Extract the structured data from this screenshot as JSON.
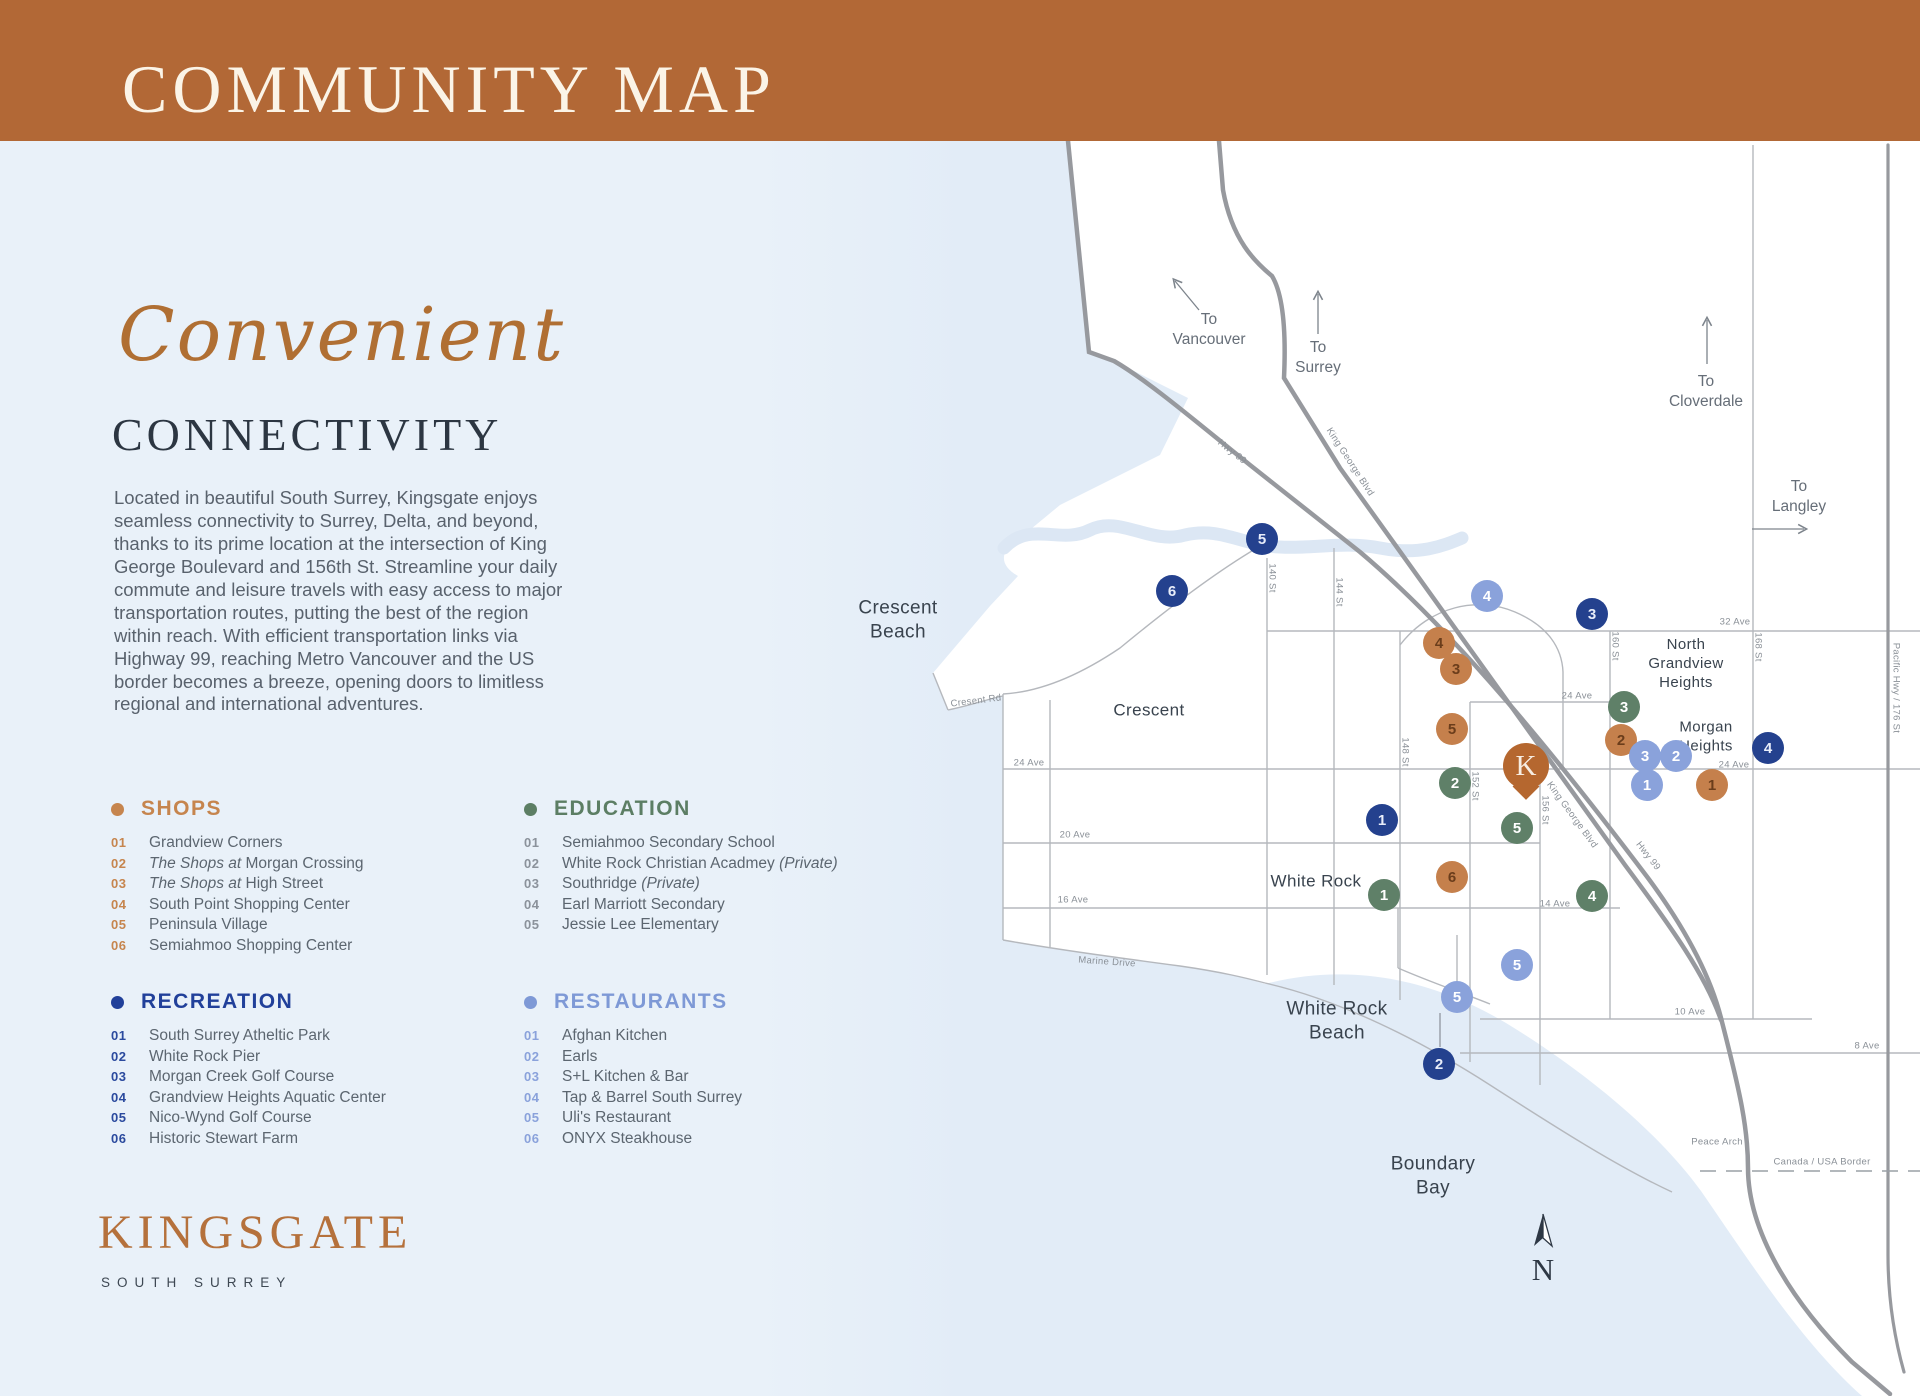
{
  "header": {
    "title": "COMMUNITY MAP"
  },
  "intro": {
    "script_word": "Convenient",
    "heading": "CONNECTIVITY",
    "paragraph": "Located in beautiful South Surrey, Kingsgate enjoys seamless connectivity to Surrey, Delta, and beyond, thanks to its prime location at the intersection of King George Boulevard and 156th St. Streamline your daily commute and leisure travels with easy access to major transportation routes, putting the best of the region within reach. With efficient transportation links via Highway 99, reaching Metro Vancouver and the US border becomes a breeze, opening doors to limitless regional and international adventures."
  },
  "legend": {
    "sections": [
      {
        "id": "shops",
        "label": "SHOPS",
        "color": "#C6854E",
        "number_color": "#C6854E",
        "items": [
          {
            "num": "01",
            "name": "Grandview Corners"
          },
          {
            "num": "02",
            "italic_prefix": "The Shops at",
            "name": " Morgan Crossing"
          },
          {
            "num": "03",
            "italic_prefix": "The Shops at",
            "name": " High Street"
          },
          {
            "num": "04",
            "name": "South Point Shopping Center"
          },
          {
            "num": "05",
            "name": "Peninsula Village"
          },
          {
            "num": "06",
            "name": "Semiahmoo Shopping Center"
          }
        ]
      },
      {
        "id": "education",
        "label": "EDUCATION",
        "color": "#5C7E64",
        "number_color": "#8B929B",
        "items": [
          {
            "num": "01",
            "name": "Semiahmoo Secondary School"
          },
          {
            "num": "02",
            "name": "White Rock Christian Acadmey ",
            "italic_suffix": "(Private)"
          },
          {
            "num": "03",
            "name": "Southridge ",
            "italic_suffix": "(Private)"
          },
          {
            "num": "04",
            "name": "Earl Marriott Secondary"
          },
          {
            "num": "05",
            "name": "Jessie Lee Elementary"
          }
        ]
      },
      {
        "id": "recreation",
        "label": "RECREATION",
        "color": "#21409A",
        "number_color": "#2B4A9E",
        "items": [
          {
            "num": "01",
            "name": "South Surrey Atheltic Park"
          },
          {
            "num": "02",
            "name": "White Rock Pier"
          },
          {
            "num": "03",
            "name": "Morgan Creek Golf Course"
          },
          {
            "num": "04",
            "name": "Grandview Heights Aquatic Center"
          },
          {
            "num": "05",
            "name": "Nico-Wynd Golf Course"
          },
          {
            "num": "06",
            "name": "Historic Stewart Farm"
          }
        ]
      },
      {
        "id": "restaurants",
        "label": "RESTAURANTS",
        "color": "#7E99D6",
        "number_color": "#8AA2DB",
        "items": [
          {
            "num": "01",
            "name": "Afghan Kitchen"
          },
          {
            "num": "02",
            "name": "Earls"
          },
          {
            "num": "03",
            "name": "S+L Kitchen & Bar"
          },
          {
            "num": "04",
            "name": "Tap & Barrel South Surrey"
          },
          {
            "num": "05",
            "name": "Uli's Restaurant"
          },
          {
            "num": "06",
            "name": "ONYX Steakhouse"
          }
        ]
      }
    ]
  },
  "logo": {
    "name": "KINGSGATE",
    "subtitle": "SOUTH SURREY"
  },
  "map": {
    "pin": {
      "letter": "K",
      "color": "#B5672F",
      "x": 1526,
      "y": 766
    },
    "compass": {
      "letter": "N"
    },
    "categories": {
      "shops": {
        "bg": "#C5804C",
        "fg": "#6B3D1B"
      },
      "education": {
        "bg": "#5F8068",
        "fg": "#FFFFFF"
      },
      "recreation": {
        "bg": "#24418E",
        "fg": "#E8EDFA"
      },
      "restaurants": {
        "bg": "#8AA2DB",
        "fg": "#FFFFFF"
      }
    },
    "markers": [
      {
        "cat": "recreation",
        "num": "5",
        "x": 1262,
        "y": 539
      },
      {
        "cat": "recreation",
        "num": "6",
        "x": 1172,
        "y": 591
      },
      {
        "cat": "recreation",
        "num": "3",
        "x": 1592,
        "y": 614
      },
      {
        "cat": "recreation",
        "num": "4",
        "x": 1768,
        "y": 748
      },
      {
        "cat": "recreation",
        "num": "1",
        "x": 1382,
        "y": 820
      },
      {
        "cat": "recreation",
        "num": "2",
        "x": 1439,
        "y": 1064
      },
      {
        "cat": "shops",
        "num": "4",
        "x": 1439,
        "y": 643
      },
      {
        "cat": "shops",
        "num": "3",
        "x": 1456,
        "y": 669
      },
      {
        "cat": "shops",
        "num": "5",
        "x": 1452,
        "y": 729
      },
      {
        "cat": "shops",
        "num": "2",
        "x": 1621,
        "y": 740
      },
      {
        "cat": "shops",
        "num": "1",
        "x": 1712,
        "y": 785
      },
      {
        "cat": "shops",
        "num": "6",
        "x": 1452,
        "y": 877
      },
      {
        "cat": "education",
        "num": "3",
        "x": 1624,
        "y": 707
      },
      {
        "cat": "education",
        "num": "2",
        "x": 1455,
        "y": 783
      },
      {
        "cat": "education",
        "num": "5",
        "x": 1517,
        "y": 828
      },
      {
        "cat": "education",
        "num": "1",
        "x": 1384,
        "y": 895
      },
      {
        "cat": "education",
        "num": "4",
        "x": 1592,
        "y": 896
      },
      {
        "cat": "restaurants",
        "num": "4",
        "x": 1487,
        "y": 596
      },
      {
        "cat": "restaurants",
        "num": "3",
        "x": 1645,
        "y": 756
      },
      {
        "cat": "restaurants",
        "num": "2",
        "x": 1676,
        "y": 756
      },
      {
        "cat": "restaurants",
        "num": "1",
        "x": 1647,
        "y": 785
      },
      {
        "cat": "restaurants",
        "num": "5",
        "x": 1517,
        "y": 965
      },
      {
        "cat": "restaurants",
        "num": "5",
        "x": 1457,
        "y": 997
      }
    ],
    "region_labels": [
      {
        "id": "crescent-beach",
        "lines": [
          "Crescent",
          "Beach"
        ],
        "x": 898,
        "y": 620,
        "size": 19
      },
      {
        "id": "crescent",
        "lines": [
          "Crescent"
        ],
        "x": 1149,
        "y": 710,
        "size": 17
      },
      {
        "id": "white-rock",
        "lines": [
          "White Rock"
        ],
        "x": 1316,
        "y": 881,
        "size": 17
      },
      {
        "id": "white-rock-beach",
        "lines": [
          "White Rock",
          "Beach"
        ],
        "x": 1337,
        "y": 1021,
        "size": 19
      },
      {
        "id": "boundary-bay",
        "lines": [
          "Boundary",
          "Bay"
        ],
        "x": 1433,
        "y": 1176,
        "size": 19
      },
      {
        "id": "north-grandview-heights",
        "lines": [
          "North",
          "Grandview",
          "Heights"
        ],
        "x": 1686,
        "y": 664,
        "size": 15
      },
      {
        "id": "morgan-heights",
        "lines": [
          "Morgan",
          "Heights"
        ],
        "x": 1706,
        "y": 737,
        "size": 15
      }
    ],
    "direction_labels": [
      {
        "id": "to-vancouver",
        "lines": [
          "To",
          "Vancouver"
        ],
        "x": 1209,
        "y": 330
      },
      {
        "id": "to-surrey",
        "lines": [
          "To",
          "Surrey"
        ],
        "x": 1318,
        "y": 358
      },
      {
        "id": "to-cloverdale",
        "lines": [
          "To",
          "Cloverdale"
        ],
        "x": 1706,
        "y": 392
      },
      {
        "id": "to-langley",
        "lines": [
          "To",
          "Langley"
        ],
        "x": 1799,
        "y": 497
      }
    ],
    "road_labels": [
      {
        "text": "Hwy 99",
        "x": 1232,
        "y": 452,
        "rot": 38
      },
      {
        "text": "King George Blvd",
        "x": 1350,
        "y": 462,
        "rot": 57
      },
      {
        "text": "King George Blvd",
        "x": 1572,
        "y": 815,
        "rot": 54
      },
      {
        "text": "Hwy 99",
        "x": 1648,
        "y": 856,
        "rot": 52
      },
      {
        "text": "Cresent Rd",
        "x": 976,
        "y": 701,
        "rot": -7
      },
      {
        "text": "Marine Drive",
        "x": 1107,
        "y": 962,
        "rot": 4
      },
      {
        "text": "Peace Arch",
        "x": 1717,
        "y": 1142,
        "rot": 0
      },
      {
        "text": "Canada / USA Border",
        "x": 1822,
        "y": 1162,
        "rot": 0
      },
      {
        "text": "32 Ave",
        "x": 1735,
        "y": 622,
        "rot": 0
      },
      {
        "text": "24 Ave",
        "x": 1577,
        "y": 696,
        "rot": 0
      },
      {
        "text": "24 Ave",
        "x": 1029,
        "y": 763,
        "rot": 0
      },
      {
        "text": "24 Ave",
        "x": 1734,
        "y": 765,
        "rot": 0
      },
      {
        "text": "20 Ave",
        "x": 1075,
        "y": 835,
        "rot": 0
      },
      {
        "text": "16 Ave",
        "x": 1073,
        "y": 900,
        "rot": 0
      },
      {
        "text": "14 Ave",
        "x": 1555,
        "y": 904,
        "rot": 0
      },
      {
        "text": "10 Ave",
        "x": 1690,
        "y": 1012,
        "rot": 0
      },
      {
        "text": "8 Ave",
        "x": 1867,
        "y": 1046,
        "rot": 0
      },
      {
        "text": "140 St",
        "x": 1272,
        "y": 578,
        "rot": 90
      },
      {
        "text": "144 St",
        "x": 1339,
        "y": 592,
        "rot": 90
      },
      {
        "text": "148 St",
        "x": 1405,
        "y": 752,
        "rot": 90
      },
      {
        "text": "152 St",
        "x": 1475,
        "y": 786,
        "rot": 90
      },
      {
        "text": "156 St",
        "x": 1545,
        "y": 810,
        "rot": 90
      },
      {
        "text": "160 St",
        "x": 1615,
        "y": 646,
        "rot": 90
      },
      {
        "text": "168 St",
        "x": 1758,
        "y": 647,
        "rot": 90
      },
      {
        "text": "Pacific Hwy / 176 St",
        "x": 1896,
        "y": 688,
        "rot": 90
      }
    ]
  }
}
